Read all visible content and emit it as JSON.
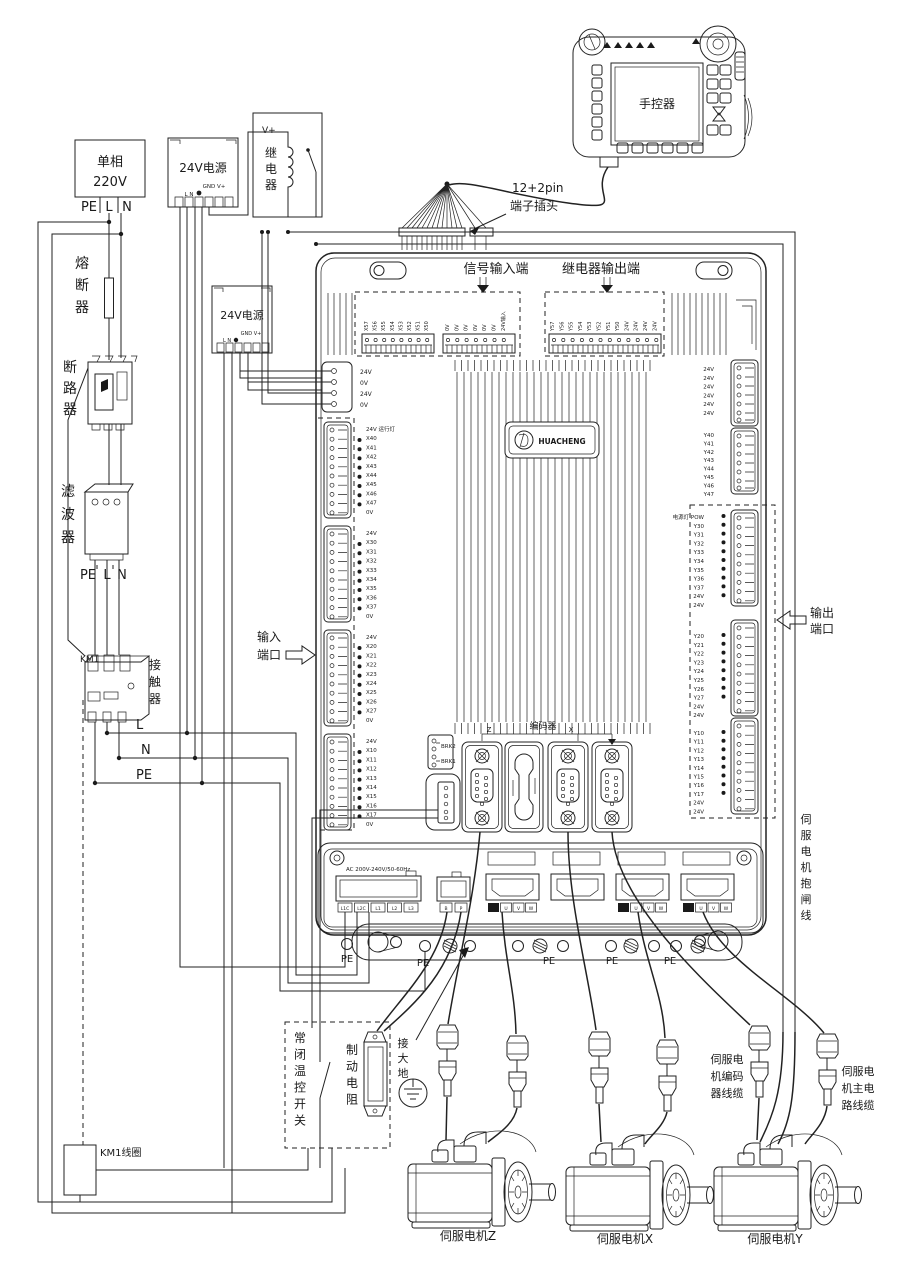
{
  "diagram": {
    "power_input": {
      "l1": "单相",
      "l2": "220V",
      "terminals": [
        "PE",
        "L",
        "N"
      ]
    },
    "fuse_label": "熔断器",
    "breaker_label": "断路器",
    "filter_label": "滤波器",
    "filter_terminals": [
      "PE",
      "L",
      "N"
    ],
    "contactor": {
      "ref": "KM1",
      "label": "接触器"
    },
    "bus_labels": [
      "L",
      "N",
      "PE"
    ],
    "km1_coil_label": "KM1线圈",
    "psu1": {
      "title": "24V电源",
      "pins_top": "GND V+",
      "pins_bottom": "L N"
    },
    "psu2": {
      "title": "24V电源",
      "pins_top": "GND V+",
      "pins_bottom": "L N"
    },
    "relay": {
      "vplus": "V+",
      "label": "继电器"
    },
    "pendant": {
      "label": "手控器"
    },
    "plug": {
      "l1": "12+2pin",
      "l2": "端子插头"
    },
    "board": {
      "signal_input_label": "信号输入端",
      "relay_output_label": "继电器输出端",
      "top_strip_x": [
        "X57",
        "X56",
        "X55",
        "X54",
        "X53",
        "X52",
        "X51",
        "X50"
      ],
      "top_strip_0v": [
        "0V",
        "0V",
        "0V",
        "0V",
        "0V",
        "0V",
        "24V输入"
      ],
      "top_strip_y": [
        "Y57",
        "Y56",
        "Y55",
        "Y54",
        "Y53",
        "Y52",
        "Y51",
        "Y50",
        "24V",
        "24V",
        "24V",
        "24V"
      ],
      "logo": "HUACHENG",
      "left_conn": [
        "24V",
        "0V",
        "24V",
        "0V"
      ],
      "left_blocks": [
        [
          "24V 运行灯",
          "X40",
          "X41",
          "X42",
          "X43",
          "X44",
          "X45",
          "X46",
          "X47",
          "0V"
        ],
        [
          "24V",
          "X30",
          "X31",
          "X32",
          "X33",
          "X34",
          "X35",
          "X36",
          "X37",
          "0V"
        ],
        [
          "24V",
          "X20",
          "X21",
          "X22",
          "X23",
          "X24",
          "X25",
          "X26",
          "X27",
          "0V"
        ],
        [
          "24V",
          "X10",
          "X11",
          "X12",
          "X13",
          "X14",
          "X15",
          "X16",
          "X17",
          "0V"
        ]
      ],
      "right_top": [
        "24V",
        "24V",
        "24V",
        "24V",
        "24V",
        "24V"
      ],
      "right_blocks": [
        [
          "Y40",
          "Y41",
          "Y42",
          "Y43",
          "Y44",
          "Y45",
          "Y46",
          "Y47"
        ],
        [
          "电源灯 POW",
          "Y30",
          "Y31",
          "Y32",
          "Y33",
          "Y34",
          "Y35",
          "Y36",
          "Y37",
          "24V",
          "24V"
        ],
        [
          "Y20",
          "Y21",
          "Y22",
          "Y23",
          "Y24",
          "Y25",
          "Y26",
          "Y27",
          "24V",
          "24V"
        ],
        [
          "Y10",
          "Y11",
          "Y12",
          "Y13",
          "Y14",
          "Y15",
          "Y16",
          "Y17",
          "24V",
          "24V"
        ]
      ],
      "input_port_label": [
        "输入",
        "端口"
      ],
      "output_port_label": [
        "输出",
        "端口"
      ],
      "brk": [
        "BRK2",
        "BRK1"
      ],
      "encoder": {
        "label": "编码器",
        "axes": [
          "Z",
          "X"
        ]
      },
      "ac_rating": "AC 200V-240V/50-60Hz",
      "power_pins": [
        "L1C",
        "L2C",
        "L1",
        "L2",
        "L3"
      ],
      "brake_pins": [
        "B",
        "P"
      ],
      "motor_pins": [
        "U",
        "V",
        "W"
      ],
      "pe_labels": [
        "PE",
        "PE",
        "PE",
        "PE",
        "PE"
      ]
    },
    "right_labels": {
      "brake_line": "伺服电机抱闸线",
      "encoder_cable": [
        "伺服电",
        "机编码",
        "器线缆"
      ],
      "power_cable": [
        "伺服电",
        "机主电",
        "路线缆"
      ]
    },
    "bottom": {
      "thermal_switch": "常闭温控开关",
      "brake_resistor": "制动电阻",
      "earth": "接大地"
    },
    "motors": [
      {
        "label": "伺服电机Z"
      },
      {
        "label": "伺服电机X"
      },
      {
        "label": "伺服电机Y"
      }
    ]
  }
}
